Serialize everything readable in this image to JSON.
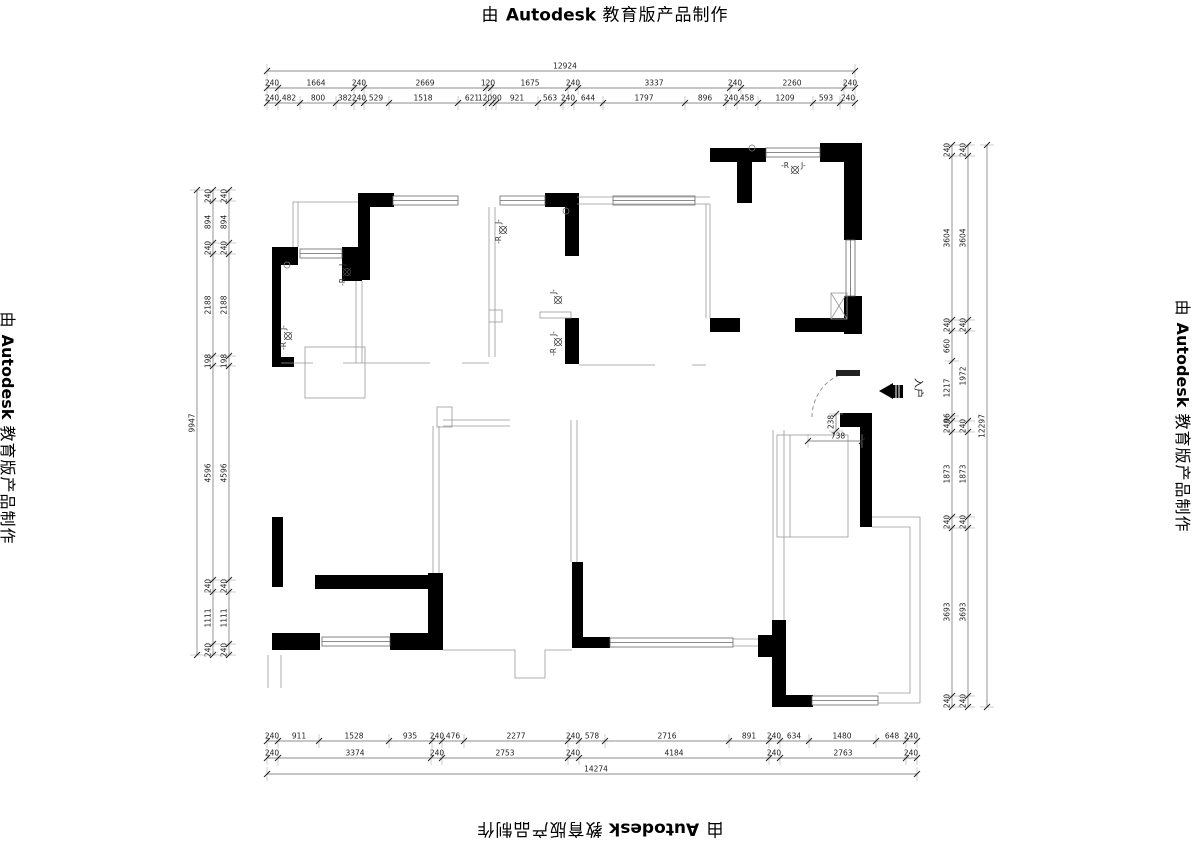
{
  "watermark": {
    "prefix": "由",
    "brand": "Autodesk",
    "suffix": "教育版产品制作"
  },
  "plan_labels": {
    "entry": "入户",
    "lamp_left": "-R",
    "lamp_right": "J-"
  },
  "dimension_rows": [
    {
      "name": "top-overall",
      "axis": "x",
      "line": 71,
      "ticks": [
        267,
        855
      ],
      "labels": [
        {
          "t": "12924",
          "p": 565
        }
      ]
    },
    {
      "name": "top-mid",
      "axis": "x",
      "line": 88,
      "ticks": [
        267,
        278,
        354,
        364,
        486,
        491,
        568,
        578,
        730,
        741,
        844,
        855
      ],
      "labels": [
        {
          "t": "240",
          "p": 272
        },
        {
          "t": "1664",
          "p": 316
        },
        {
          "t": "240",
          "p": 359
        },
        {
          "t": "2669",
          "p": 425
        },
        {
          "t": "120",
          "p": 488
        },
        {
          "t": "1675",
          "p": 530
        },
        {
          "t": "240",
          "p": 573
        },
        {
          "t": "3337",
          "p": 654
        },
        {
          "t": "240",
          "p": 735
        },
        {
          "t": "2260",
          "p": 792
        },
        {
          "t": "240",
          "p": 850
        }
      ]
    },
    {
      "name": "top-fine",
      "axis": "x",
      "line": 103,
      "ticks": [
        267,
        278,
        300,
        336,
        354,
        364,
        389,
        458,
        486,
        492,
        496,
        538,
        563,
        574,
        603,
        685,
        726,
        737,
        758,
        813,
        840,
        855
      ],
      "labels": [
        {
          "t": "240",
          "p": 272
        },
        {
          "t": "482",
          "p": 289
        },
        {
          "t": "800",
          "p": 318
        },
        {
          "t": "382",
          "p": 345
        },
        {
          "t": "240",
          "p": 359
        },
        {
          "t": "529",
          "p": 376
        },
        {
          "t": "1518",
          "p": 423
        },
        {
          "t": "621",
          "p": 472
        },
        {
          "t": "120",
          "p": 485
        },
        {
          "t": "90",
          "p": 497
        },
        {
          "t": "921",
          "p": 517
        },
        {
          "t": "563",
          "p": 550
        },
        {
          "t": "240",
          "p": 568
        },
        {
          "t": "644",
          "p": 588
        },
        {
          "t": "1797",
          "p": 644
        },
        {
          "t": "896",
          "p": 705
        },
        {
          "t": "240",
          "p": 731
        },
        {
          "t": "458",
          "p": 747
        },
        {
          "t": "1209",
          "p": 785
        },
        {
          "t": "593",
          "p": 826
        },
        {
          "t": "240",
          "p": 848
        }
      ]
    },
    {
      "name": "left-overall",
      "axis": "y",
      "line": 197,
      "ticks": [
        190,
        655
      ],
      "labels": [
        {
          "t": "9947",
          "p": 423
        }
      ]
    },
    {
      "name": "left-outer",
      "axis": "y",
      "line": 213,
      "ticks": [
        190,
        201,
        243,
        254,
        356,
        366,
        580,
        592,
        644,
        655
      ],
      "labels": [
        {
          "t": "240",
          "p": 196
        },
        {
          "t": "894",
          "p": 222
        },
        {
          "t": "240",
          "p": 248
        },
        {
          "t": "2188",
          "p": 305
        },
        {
          "t": "198",
          "p": 361
        },
        {
          "t": "4596",
          "p": 473
        },
        {
          "t": "240",
          "p": 586
        },
        {
          "t": "1111",
          "p": 618
        },
        {
          "t": "240",
          "p": 650
        }
      ]
    },
    {
      "name": "left-inner",
      "axis": "y",
      "line": 229,
      "ticks": [
        190,
        201,
        243,
        254,
        356,
        366,
        580,
        592,
        644,
        655
      ],
      "labels": [
        {
          "t": "240",
          "p": 196
        },
        {
          "t": "894",
          "p": 222
        },
        {
          "t": "240",
          "p": 248
        },
        {
          "t": "2188",
          "p": 305
        },
        {
          "t": "198",
          "p": 361
        },
        {
          "t": "4596",
          "p": 473
        },
        {
          "t": "240",
          "p": 586
        },
        {
          "t": "1111",
          "p": 618
        },
        {
          "t": "240",
          "p": 650
        }
      ]
    },
    {
      "name": "right-inner",
      "axis": "y",
      "line": 952,
      "ticks": [
        145,
        156,
        320,
        331,
        361,
        416,
        421,
        432,
        517,
        528,
        696,
        707
      ],
      "labels": [
        {
          "t": "240",
          "p": 150
        },
        {
          "t": "3604",
          "p": 238
        },
        {
          "t": "240",
          "p": 325
        },
        {
          "t": "660",
          "p": 346
        },
        {
          "t": "1217",
          "p": 388
        },
        {
          "t": "96",
          "p": 418
        },
        {
          "t": "240",
          "p": 426
        },
        {
          "t": "1873",
          "p": 474
        },
        {
          "t": "240",
          "p": 522
        },
        {
          "t": "3693",
          "p": 612
        },
        {
          "t": "240",
          "p": 701
        }
      ]
    },
    {
      "name": "right-outer",
      "axis": "y",
      "line": 968,
      "ticks": [
        145,
        156,
        320,
        331,
        421,
        432,
        517,
        528,
        696,
        707
      ],
      "labels": [
        {
          "t": "240",
          "p": 150
        },
        {
          "t": "3604",
          "p": 238
        },
        {
          "t": "240",
          "p": 325
        },
        {
          "t": "1972",
          "p": 376
        },
        {
          "t": "240",
          "p": 426
        },
        {
          "t": "1873",
          "p": 474
        },
        {
          "t": "240",
          "p": 522
        },
        {
          "t": "3693",
          "p": 612
        },
        {
          "t": "240",
          "p": 701
        }
      ]
    },
    {
      "name": "right-overall",
      "axis": "y",
      "line": 987,
      "ticks": [
        145,
        707
      ],
      "labels": [
        {
          "t": "12297",
          "p": 426
        }
      ]
    },
    {
      "name": "bottom-fine",
      "axis": "x",
      "line": 741,
      "ticks": [
        267,
        278,
        319,
        389,
        432,
        442,
        464,
        568,
        579,
        605,
        729,
        769,
        780,
        809,
        876,
        906,
        917
      ],
      "labels": [
        {
          "t": "240",
          "p": 272
        },
        {
          "t": "911",
          "p": 299
        },
        {
          "t": "1528",
          "p": 354
        },
        {
          "t": "935",
          "p": 410
        },
        {
          "t": "240",
          "p": 437
        },
        {
          "t": "476",
          "p": 453
        },
        {
          "t": "2277",
          "p": 516
        },
        {
          "t": "240",
          "p": 573
        },
        {
          "t": "578",
          "p": 592
        },
        {
          "t": "2716",
          "p": 667
        },
        {
          "t": "891",
          "p": 749
        },
        {
          "t": "240",
          "p": 774
        },
        {
          "t": "634",
          "p": 794
        },
        {
          "t": "1480",
          "p": 842
        },
        {
          "t": "648",
          "p": 892
        },
        {
          "t": "240",
          "p": 911
        }
      ]
    },
    {
      "name": "bottom-mid",
      "axis": "x",
      "line": 758,
      "ticks": [
        267,
        278,
        431,
        442,
        568,
        579,
        769,
        780,
        906,
        917
      ],
      "labels": [
        {
          "t": "240",
          "p": 272
        },
        {
          "t": "3374",
          "p": 355
        },
        {
          "t": "240",
          "p": 437
        },
        {
          "t": "2753",
          "p": 505
        },
        {
          "t": "240",
          "p": 573
        },
        {
          "t": "4184",
          "p": 674
        },
        {
          "t": "240",
          "p": 774
        },
        {
          "t": "2763",
          "p": 843
        },
        {
          "t": "240",
          "p": 911
        }
      ]
    },
    {
      "name": "bottom-overall",
      "axis": "x",
      "line": 774,
      "ticks": [
        267,
        917
      ],
      "labels": [
        {
          "t": "14274",
          "p": 596
        }
      ]
    },
    {
      "name": "entry-door-width",
      "axis": "x",
      "line": 441,
      "ticks": [
        808,
        862
      ],
      "labels": [
        {
          "t": "738",
          "p": 838
        }
      ]
    },
    {
      "name": "entry-door-offset",
      "axis": "y",
      "line": 836,
      "ticks": [
        414,
        431
      ],
      "labels": [
        {
          "t": "238",
          "p": 422
        }
      ]
    }
  ]
}
